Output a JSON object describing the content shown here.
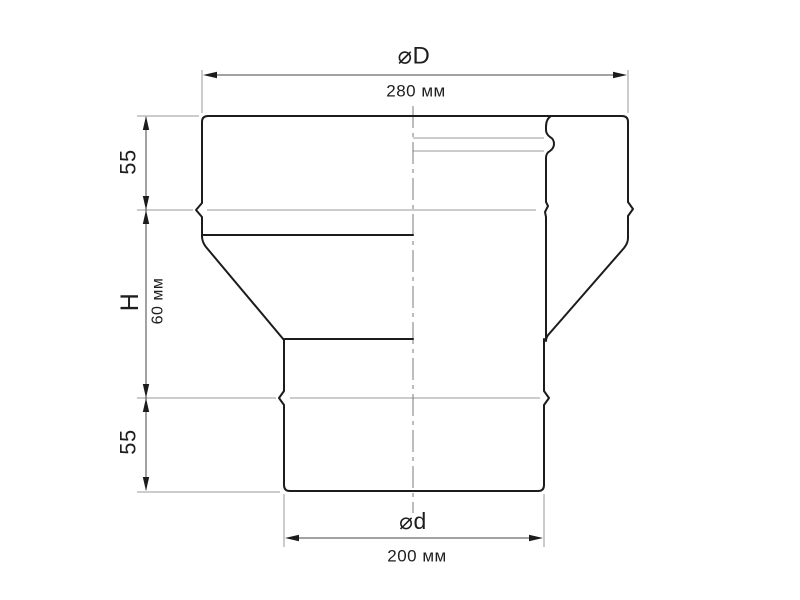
{
  "drawing": {
    "type": "technical-drawing",
    "subject": "pipe-reducer-adapter",
    "labels": {
      "top_diameter_symbol": "⌀D",
      "top_diameter_value": "280 мм",
      "bottom_diameter_symbol": "⌀d",
      "bottom_diameter_value": "200 мм",
      "upper_section_height": "55",
      "middle_section_symbol": "H",
      "middle_section_value": "60 мм",
      "lower_section_height": "55"
    },
    "colors": {
      "outline": "#1c1c1c",
      "thin_line": "#9a9a9a",
      "dimension_line": "#454545",
      "centerline": "#787878",
      "background": "#ffffff"
    }
  }
}
